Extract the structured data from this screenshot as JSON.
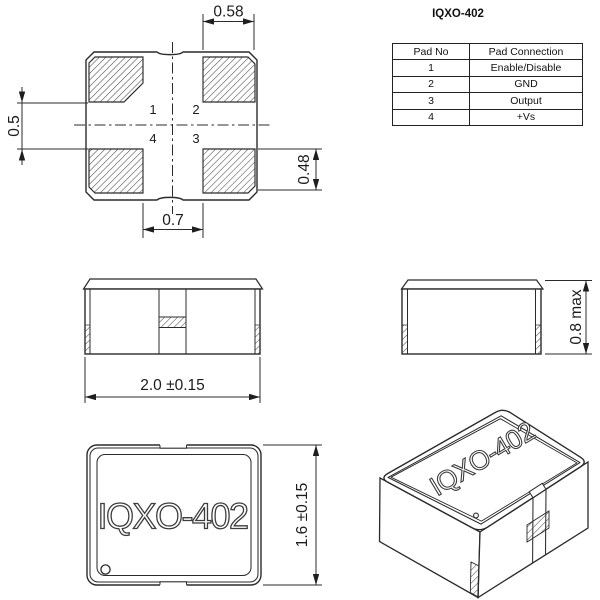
{
  "pad_layout": {
    "pads": [
      "1",
      "2",
      "3",
      "4"
    ],
    "dim_top": "0.58",
    "dim_left": "0.5",
    "dim_right": "0.48",
    "dim_bottom": "0.7"
  },
  "pad_table": {
    "title": "IQXO-402",
    "col_pad_no": "Pad No",
    "col_pad_connection": "Pad Connection",
    "rows": [
      {
        "pad_no": "1",
        "connection": "Enable/Disable"
      },
      {
        "pad_no": "2",
        "connection": "GND"
      },
      {
        "pad_no": "3",
        "connection": "Output"
      },
      {
        "pad_no": "4",
        "connection": "+Vs"
      }
    ]
  },
  "front_view": {
    "width_dim": "2.0 ±0.15"
  },
  "side_view": {
    "height_dim": "0.8 max"
  },
  "top_view": {
    "marking": "IQXO-402",
    "height_dim": "1.6 ±0.15"
  },
  "iso_view": {
    "marking": "IQXO-402"
  },
  "colors": {
    "line": "#2b2b2b",
    "background": "#ffffff"
  }
}
